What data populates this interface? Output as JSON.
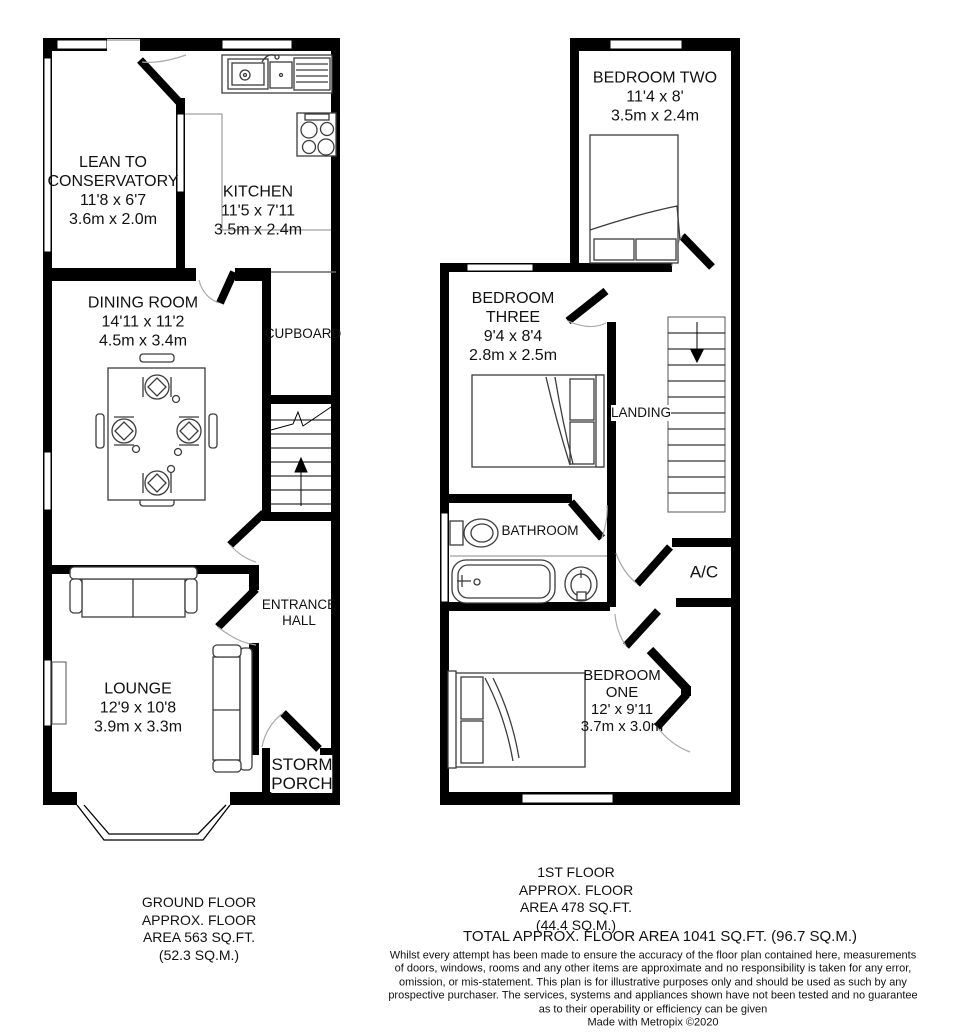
{
  "colors": {
    "wall": "#000000",
    "background": "#ffffff",
    "door_arc": "#aaaaaa",
    "furniture_outline": "#3c3c3c",
    "text": "#111111"
  },
  "ground_floor": {
    "rooms": {
      "conservatory": "LEAN TO\nCONSERVATORY\n11'8 x 6'7\n3.6m x 2.0m",
      "kitchen": "KITCHEN\n11'5 x 7'11\n3.5m x 2.4m",
      "dining_room": "DINING ROOM\n14'11 x 11'2\n4.5m x 3.4m",
      "cupboard": "CUPBOARD",
      "entrance_hall": "ENTRANCE\nHALL",
      "lounge": "LOUNGE\n12'9 x 10'8\n3.9m x 3.3m",
      "storm_porch": "STORM\nPORCH"
    },
    "caption": "GROUND FLOOR\nAPPROX. FLOOR\nAREA 563 SQ.FT.\n(52.3 SQ.M.)"
  },
  "first_floor": {
    "rooms": {
      "bedroom_two": "BEDROOM TWO\n11'4 x 8'\n3.5m x 2.4m",
      "bedroom_three": "BEDROOM\nTHREE\n9'4 x 8'4\n2.8m x 2.5m",
      "landing": "LANDING",
      "bathroom": "BATHROOM",
      "ac": "A/C",
      "bedroom_one": "BEDROOM\nONE\n12' x 9'11\n3.7m x 3.0m"
    },
    "caption": "1ST FLOOR\nAPPROX. FLOOR\nAREA 478 SQ.FT.\n(44.4 SQ.M.)"
  },
  "totals": {
    "total_area": "TOTAL APPROX. FLOOR AREA 1041 SQ.FT. (96.7 SQ.M.)"
  },
  "disclaimer": "Whilst every attempt has been made to ensure the accuracy of the floor plan contained here, measurements\nof doors, windows, rooms and any other items are approximate and no responsibility is taken for any error,\nomission, or mis-statement. This plan is for illustrative purposes only and should be used as such by any\nprospective purchaser. The services, systems and appliances shown have not been tested and no guarantee\nas to their operability or efficiency can be given",
  "credit": "Made with Metropix ©2020",
  "icons": [
    "bed-icon",
    "bathtub-icon",
    "toilet-icon",
    "basin-icon",
    "kitchen-sink-icon",
    "hob-icon",
    "sofa-icon",
    "dining-table-icon",
    "chair-icon",
    "stairs-up-icon",
    "stairs-down-icon",
    "door-icon",
    "window-icon",
    "bay-window-icon"
  ]
}
